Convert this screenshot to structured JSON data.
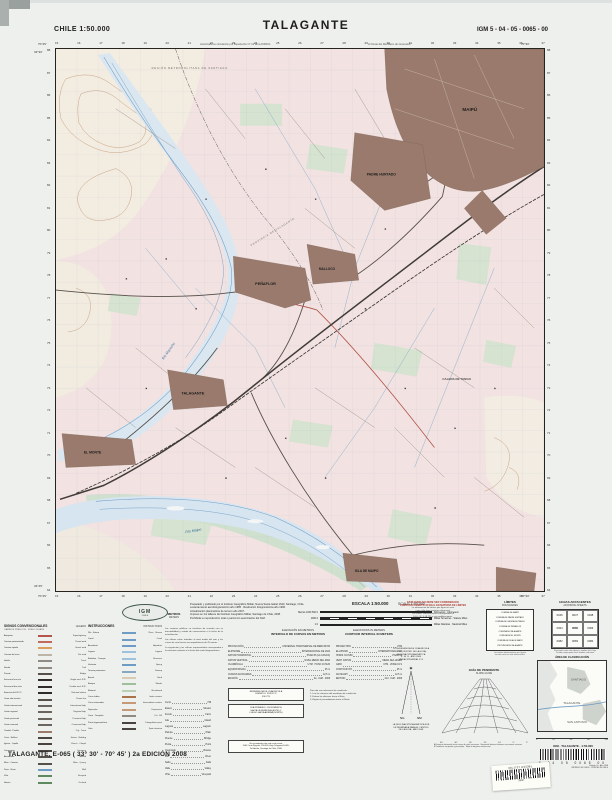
{
  "header": {
    "left": "CHILE  1:50.000",
    "title": "TALAGANTE",
    "right": "IGM 5 - 04 - 05 - 0065 - 00",
    "note_left": "Autorizada su circulación por Resolución N° 13 de la DIFROL",
    "note_right": "Al Oeste del Meridiano de Greenwich"
  },
  "map": {
    "corners": {
      "nw_lon": "70°45'",
      "ne_lon": "70°30'",
      "lat_n": "33°30'",
      "lat_s": "33°45'"
    },
    "grid_top": [
      "15",
      "16",
      "17",
      "18",
      "19",
      "20",
      "21",
      "22",
      "23",
      "24",
      "25",
      "26",
      "27",
      "28",
      "29",
      "30",
      "31",
      "32",
      "33",
      "34",
      "35",
      "36",
      "37"
    ],
    "grid_left": [
      "88",
      "87",
      "86",
      "85",
      "84",
      "83",
      "82",
      "81",
      "80",
      "79",
      "78",
      "77",
      "76",
      "75",
      "74",
      "73",
      "72",
      "71",
      "70",
      "69",
      "68",
      "67",
      "66",
      "65",
      "64"
    ],
    "labels": {
      "maipu": "MAIPÚ",
      "padre_hurtado": "PADRE HURTADO",
      "malloco": "MALLOCO",
      "penaflor": "PEÑAFLOR",
      "talagante": "TALAGANTE",
      "el_monte": "EL MONTE",
      "isla_maipo": "ISLA DE MAIPO",
      "calera": "CALERA DE TANGO",
      "rio_mapocho": "Río Mapocho",
      "rio_maipo": "Río Maipo",
      "region": "REGIÓN METROPOLITANA DE SANTIAGO",
      "provincia": "PROVINCIA DE TALAGANTE"
    }
  },
  "logo": {
    "text": "IGM",
    "country": "CHILE"
  },
  "credits": [
    "Preparado y publicado por el Instituto Geográfico Militar, Nueva Santa Isabel 1640, Santiago, Chile.",
    "Levantamiento aerofotogramétrico año 1995 · Restitución fotogramétrica año 1996.",
    "Actualización planimétrica de terreno año 2007.",
    "Impreso en los talleres del Instituto Geográfico Militar, Santiago de Chile, 2008.",
    "Prohibida su reproducción total o parcial sin autorización del IGM."
  ],
  "metros": {
    "es": "METROS",
    "en": "METERS"
  },
  "scale": {
    "title_es": "ESCALA 1:50.000",
    "title_en": "SCALE 1:50.000",
    "bars": [
      {
        "l": "Metros 1000 500 0",
        "r": "Kilómetros · Kilometers"
      },
      {
        "l": "1000 0",
        "r": "Millas Terrestres · Statute Miles"
      },
      {
        "l": "1 0",
        "r": "Millas Náuticas · Nautical Miles"
      }
    ]
  },
  "warning": {
    "red": [
      "ESTE MAPA NO DEBE SER CONSIDERADO",
      "COMO DOCUMENTO OFICIAL EN MATERIA DE LÍMITES"
    ],
    "black": [
      "La información de límites que figura en esta",
      "carta sólo tiene carácter referencial.",
      "Los límites administrativos corresponden al",
      "D.F.L. N° 3-18.715 y sus modificaciones."
    ]
  },
  "limites": {
    "title": "LÍMITES",
    "subtitle": "BOUNDARIES",
    "names": [
      "COMUNA DE MAIPÚ",
      "COMUNA DE PADRE HURTADO",
      "COMUNA DE CALERA DE TANGO",
      "COMUNA DE PEÑAFLOR",
      "COMUNA DE TALAGANTE",
      "COMUNA DE EL MONTE",
      "COMUNA DE ISLA DE MAIPO",
      "PROVINCIA DE TALAGANTE"
    ],
    "note": [
      "Los límites administrativos que figuran",
      "en esta carta son sólo referenciales."
    ]
  },
  "adjoining": {
    "title": "HOJAS ADYACENTES",
    "subtitle": "ADJOINING SHEETS",
    "cells": [
      "0046",
      "0047",
      "0048",
      "0064",
      "0065",
      "0066",
      "0082",
      "0083",
      "0084"
    ],
    "note": [
      "Para pedir cartas cite número y nombre de la hoja",
      "To order maps quote sheet number and name"
    ]
  },
  "elevation": {
    "es": [
      "ELEVACIÓN EN METROS",
      "INTERVALO DE CURVAS EN METROS"
    ],
    "en": [
      "ELEVATIONS IN METERS",
      "CONTOUR INTERVAL IN METERS"
    ],
    "datum_es": [
      {
        "k": "PROYECCIÓN",
        "v": "UNIVERSAL TRANSVERSAL DE MERCATOR"
      },
      {
        "k": "ELIPSOIDE",
        "v": "INTERNACIONAL DE 1924"
      },
      {
        "k": "DATUM HORIZONTAL",
        "v": "PSAD-56 (LA CANOA)"
      },
      {
        "k": "DATUM VERTICAL",
        "v": "NIVEL MEDIO DEL MAR"
      },
      {
        "k": "CUADRÍCULA",
        "v": "UTM · HUSO 19 SUR"
      },
      {
        "k": "EQUIDISTANCIA",
        "v": "25 m"
      },
      {
        "k": "CURVAS AUXILIARES",
        "v": "12,5 m"
      },
      {
        "k": "EDICIÓN",
        "v": "2a · IGM · 2008"
      }
    ],
    "datum_en": [
      {
        "k": "PROJECTION",
        "v": "UTM"
      },
      {
        "k": "ELLIPSOID",
        "v": "INTERNATIONAL 1924"
      },
      {
        "k": "HORIZ. DATUM",
        "v": "PSAD-56"
      },
      {
        "k": "VERT. DATUM",
        "v": "MEAN SEA LEVEL"
      },
      {
        "k": "GRID",
        "v": "UTM · ZONE 19 S"
      },
      {
        "k": "CONTOUR INT.",
        "v": "25 m"
      },
      {
        "k": "AUXILIARY",
        "v": "12.5 m"
      },
      {
        "k": "EDITION",
        "v": "2nd · IGM · 2008"
      }
    ]
  },
  "legend": {
    "title_es": "SIGNOS CONVENCIONALES",
    "title_en": "LEGEND",
    "sub": "CAMINOS PÚBLICOS · PUBLIC ROADS",
    "rows": [
      {
        "es": "Autopista",
        "en": "Superhighway",
        "c": "#b5544a"
      },
      {
        "es": "Camino pavimentado",
        "en": "Paved road",
        "c": "#c26b5a"
      },
      {
        "es": "Camino ripiado",
        "en": "Gravel road",
        "c": "#d99f5b"
      },
      {
        "es": "Camino de tierra",
        "en": "Dirt road",
        "c": "#bdb4a6"
      },
      {
        "es": "Huella",
        "en": "Track",
        "c": "#8f8a84"
      },
      {
        "es": "Senda",
        "en": "Trail",
        "c": "#8f8a84"
      },
      {
        "es": "Puente",
        "en": "Bridge",
        "c": "#55504a"
      },
      {
        "es": "Ferrocarril una vía",
        "en": "Single track R.R.",
        "c": "#2e2b28"
      },
      {
        "es": "Ferrocarril dos vías",
        "en": "Double track R.R.",
        "c": "#2e2b28"
      },
      {
        "es": "Estación de FF.CC.",
        "en": "Railroad station",
        "c": "#2e2b28"
      },
      {
        "es": "Línea alta tensión",
        "en": "Power line",
        "c": "#55504a"
      },
      {
        "es": "Límite internacional",
        "en": "International bdy.",
        "c": "#6b6560"
      },
      {
        "es": "Límite regional",
        "en": "Regional bdy.",
        "c": "#6b6560"
      },
      {
        "es": "Límite provincial",
        "en": "Provincial bdy.",
        "c": "#6b6560"
      },
      {
        "es": "Límite comunal",
        "en": "Communal bdy.",
        "c": "#6b6560"
      },
      {
        "es": "Ciudad · Pueblo",
        "en": "City · Town",
        "c": "#9b7a6c"
      },
      {
        "es": "Casa · Edificio",
        "en": "House · Building",
        "c": "#4a4440"
      },
      {
        "es": "Iglesia · Capilla",
        "en": "Church · Chapel",
        "c": "#4a4440"
      },
      {
        "es": "Cementerio",
        "en": "Cemetery",
        "c": "#4a4440"
      },
      {
        "es": "Aeródromo",
        "en": "Airfield",
        "c": "#55504a"
      },
      {
        "es": "Mina · Cantera",
        "en": "Mine · Quarry",
        "c": "#55504a"
      },
      {
        "es": "Pozo · Noria",
        "en": "Well",
        "c": "#6f9cc4"
      },
      {
        "es": "Viña",
        "en": "Vineyard",
        "c": "#5d8a5f"
      },
      {
        "es": "Huerto",
        "en": "Orchard",
        "c": "#5d8a5f"
      }
    ]
  },
  "instrucciones": {
    "title_es": "INSTRUCCIONES",
    "title_en": "INSTRUCTIONS",
    "rows": [
      {
        "es": "Río · Estero",
        "en": "River · Stream",
        "c": "#6f9cc4"
      },
      {
        "es": "Canal",
        "en": "Canal",
        "c": "#6f9cc4"
      },
      {
        "es": "Acueducto",
        "en": "Aqueduct",
        "c": "#6f9cc4"
      },
      {
        "es": "Laguna",
        "en": "Lagoon",
        "c": "#9fc2dc"
      },
      {
        "es": "Embalse · Tranque",
        "en": "Reservoir",
        "c": "#9fc2dc"
      },
      {
        "es": "Vertiente",
        "en": "Spring",
        "c": "#6f9cc4"
      },
      {
        "es": "Terreno pantanoso",
        "en": "Swamp",
        "c": "#86a8c0"
      },
      {
        "es": "Arenal",
        "en": "Sand",
        "c": "#d8cbb4"
      },
      {
        "es": "Bosque",
        "en": "Woods",
        "c": "#9dbf9a"
      },
      {
        "es": "Matorral",
        "en": "Brushwood",
        "c": "#b9d0b4"
      },
      {
        "es": "Curva índice",
        "en": "Index contour",
        "c": "#a9744c"
      },
      {
        "es": "Curva intermedia",
        "en": "Intermediate contour",
        "c": "#c49a78"
      },
      {
        "es": "Depresión",
        "en": "Depression",
        "c": "#c49a78"
      },
      {
        "es": "Corte · Terraplén",
        "en": "Cut · Fill",
        "c": "#8f8a84"
      },
      {
        "es": "Punto trigonométrico",
        "en": "Triangulation point",
        "c": "#4a4440"
      },
      {
        "es": "Cota",
        "en": "Spot elevation",
        "c": "#4a4440"
      }
    ]
  },
  "notes": [
    "Los caminos públicos se clasifican de acuerdo con su transitabilidad y estado de conservación a la fecha de la actualización.",
    "Las alturas están referidas al nivel medio del mar y las curvas de nivel tienen una equidistancia de 25 metros.",
    "La vegetación y los cultivos representados corresponden a la situación existente a la fecha del vuelo fotogramétrico."
  ],
  "vocab": [
    {
      "es": "Cerro",
      "en": "Hill"
    },
    {
      "es": "Estero",
      "en": "Stream"
    },
    {
      "es": "Fundo",
      "en": "Farm"
    },
    {
      "es": "Isla",
      "en": "Island"
    },
    {
      "es": "Laguna",
      "en": "Lagoon"
    },
    {
      "es": "Pampa",
      "en": "Plain"
    },
    {
      "es": "Puente",
      "en": "Bridge"
    },
    {
      "es": "Punta",
      "en": "Point"
    },
    {
      "es": "Quebrada",
      "en": "Ravine"
    },
    {
      "es": "Río",
      "en": "River"
    },
    {
      "es": "Salto",
      "en": "Falls"
    },
    {
      "es": "Valle",
      "en": "Valley"
    },
    {
      "es": "Viña",
      "en": "Vineyard"
    }
  ],
  "refbox1": [
    "REFERENCIA DE CUADRÍCULA",
    "EJEMPLO: PUNTO P",
    "330 725"
  ],
  "refbox2": [
    "LEA PRIMERO LOS NÚMEROS",
    "HACIA LA DERECHA (ESTE) Y",
    "LUEGO HACIA ARRIBA (NORTE)"
  ],
  "refside": [
    "Para dar una referencia de cuadrícula:",
    "1. Lea los números del meridiano de cuadrícula.",
    "2. Estime los décimos hacia el Este.",
    "3. Repita el procedimiento hacia el Norte."
  ],
  "cite": [
    "Se recomienda citar esta carta como:",
    "IGM, Carta Regular 1:50.000, Hoja Talagante E-065,",
    "2a Edición, Santiago de Chile, 2008."
  ],
  "declination": {
    "top": [
      "CONVERGENCIA DE CUADRÍCULA",
      "1° 15´ (CENTRO DE LA HOJA)",
      "DECLINACIÓN MAGNÉTICA",
      "4° 30´ E · AÑO 2008",
      "VARIACIÓN ANUAL 8´ E"
    ],
    "ng": "NG",
    "nm": "NM",
    "star": "✶",
    "bottom": [
      "LA DECLINACIÓN MAGNÉTICA FUE",
      "DETERMINADA PARA EL CENTRO",
      "DE LA HOJA · AÑO 2008"
    ]
  },
  "slope": {
    "title_es": "GUÍA DE PENDIENTE",
    "title_en": "SLOPE GUIDE",
    "degrees": [
      "45°",
      "30°",
      "20°",
      "15°",
      "10°",
      "5°",
      "2°"
    ],
    "footnotes": [
      "A  Distancia horizontal entre curvas de nivel sucesivas · Horizontal distance between successive contours",
      "B  Pendiente en grados y porcentaje · Slope in degrees and percent"
    ]
  },
  "classification": {
    "title": "ÁREA DE CLASIFICACIÓN",
    "labels": {
      "a": "SANTIAGO",
      "b": "TALAGANTE",
      "c": "SAN ANTONIO"
    },
    "scale": [
      "0",
      "20",
      "40",
      "60",
      "Km"
    ]
  },
  "footer": {
    "left": "TALAGANTE, E-065 ( 33° 30' - 70° 45' ) 2a EDICIÓN 2008"
  },
  "barcode": {
    "label": "IGM · TALAGANTE · 1:50.000",
    "digits": "5  04  05  0065  00",
    "sub": [
      "Edición 2a · Año 2008",
      "IMPRESO EN CHILE · PRINTED IN CHILE"
    ]
  },
  "sticker": {
    "text": "33L1737 H533BL",
    "num": "33037"
  }
}
